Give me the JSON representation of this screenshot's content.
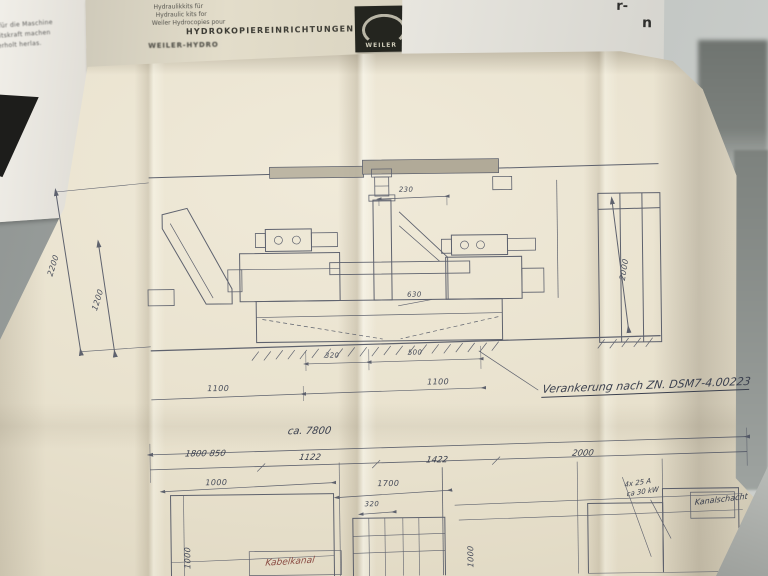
{
  "papers": {
    "left_note_lines": [
      "e für die Maschine",
      "beitskraft machen",
      "ederholt herlas."
    ],
    "brochure": {
      "tagline_lines": [
        "Hydraulikkits für",
        "Hydraulic kits for",
        "Weiler Hydrocopies pour"
      ],
      "heading": "HYDROKOPIEREINRICHTUNGEN",
      "subheading_fragment": "WEILER-HYDRO",
      "logo_text": "WEILER"
    },
    "top_right_fragments": [
      "r-",
      "n"
    ]
  },
  "drawing": {
    "elevation": {
      "dim_left_outer": "2200",
      "dim_left_inner": "1200",
      "dim_right": "2000",
      "dim_top_small": "230",
      "dim_center_small": "630",
      "dim_base_small_1": "320",
      "dim_base_small_2": "500",
      "dim_base_1": "1100",
      "dim_base_2": "1100",
      "anchor_note": "Verankerung nach ZN. DSM7-4.00223"
    },
    "plan": {
      "dim_overall": "ca. 7800",
      "dim_chain": [
        "1800  850",
        "1122",
        "1422",
        "2000"
      ],
      "dim_left_width": "1000",
      "dim_left_height": "1000",
      "dim_center_width": "1700",
      "dim_center_small": "320",
      "dim_center_height": "1000",
      "note_power_1": "4x 25 A",
      "note_power_2": "ca 30 kW",
      "note_channel": "Kanalschacht",
      "note_red": "Kabelkanal"
    }
  }
}
